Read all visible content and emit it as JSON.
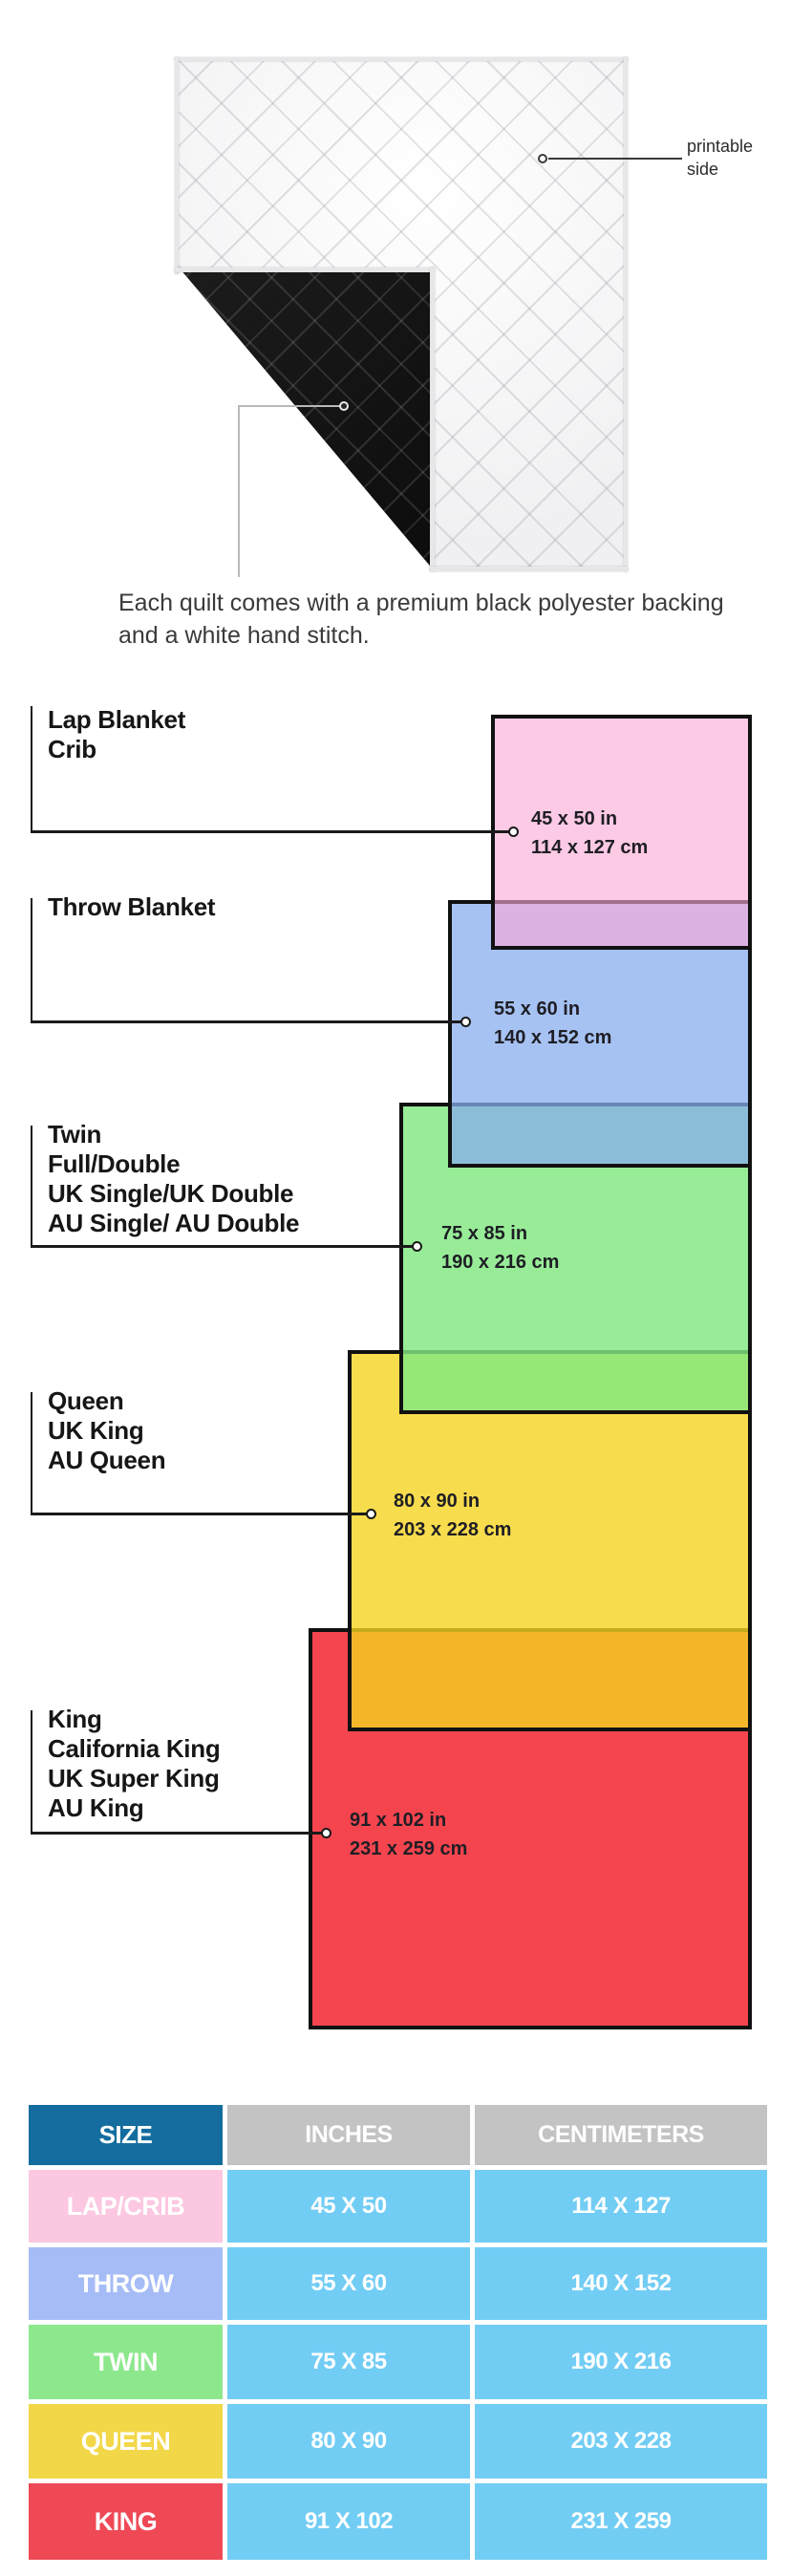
{
  "hero": {
    "printable_side_label": "printable side",
    "caption": "Each quilt comes with a premium black polyester backing and a white hand stitch.",
    "front_side": "white quilted printable side",
    "back_side": "black polyester backing"
  },
  "diagram": {
    "items": [
      {
        "names": [
          "Lap Blanket",
          "Crib"
        ],
        "inches": "45 x 50 in",
        "cm": "114 x 127 cm",
        "color": "#FDCAE5"
      },
      {
        "names": [
          "Throw Blanket"
        ],
        "inches": "55 x 60 in",
        "cm": "140 x 152 cm",
        "color": "#A6C2F2"
      },
      {
        "names": [
          "Twin",
          "Full/Double",
          "UK Single/UK Double",
          "AU Single/ AU Double"
        ],
        "inches": "75 x 85 in",
        "cm": "190 x 216 cm",
        "color": "#98EC98"
      },
      {
        "names": [
          "Queen",
          "UK King",
          "AU Queen"
        ],
        "inches": "80 x 90 in",
        "cm": "203 x 228 cm",
        "color": "#F7DC4D"
      },
      {
        "names": [
          "King",
          "California King",
          "UK Super King",
          "AU King"
        ],
        "inches": "91 x 102 in",
        "cm": "231 x 259 cm",
        "color": "#F4454F"
      }
    ]
  },
  "table": {
    "headers": [
      "SIZE",
      "INCHES",
      "CENTIMETERS"
    ],
    "header_bg": "#146D9E",
    "data_bg": "#72CDF4",
    "rows": [
      {
        "size": "LAP/CRIB",
        "inches": "45 X 50",
        "cm": "114 X 127",
        "color": "#FBC7E1"
      },
      {
        "size": "THROW",
        "inches": "55 X 60",
        "cm": "140 X 152",
        "color": "#A6BCF6"
      },
      {
        "size": "TWIN",
        "inches": "75 X 85",
        "cm": "190 X 216",
        "color": "#8DE88D"
      },
      {
        "size": "QUEEN",
        "inches": "80 X 90",
        "cm": "203 X 228",
        "color": "#F2D748"
      },
      {
        "size": "KING",
        "inches": "91 X 102",
        "cm": "231 X 259",
        "color": "#EF4956"
      }
    ]
  }
}
